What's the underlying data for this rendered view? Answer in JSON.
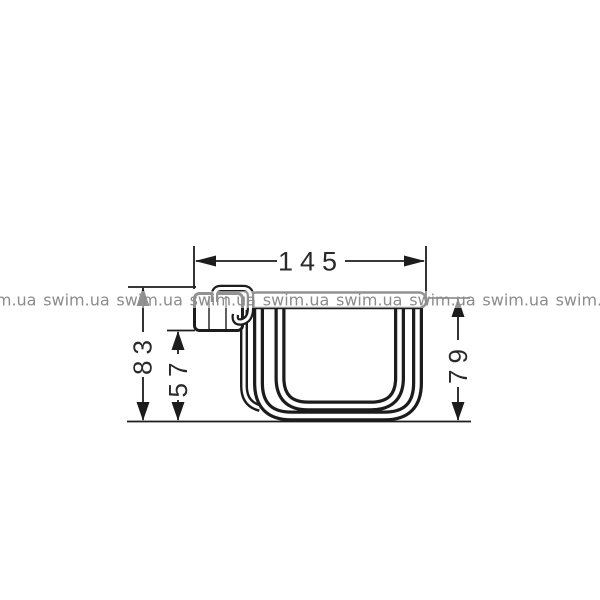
{
  "watermark": {
    "text": "swim.ua"
  },
  "dimensions": {
    "width": "145",
    "overall_height": "83",
    "basket_height": "57",
    "right_height": "79"
  },
  "colors": {
    "line": "#1c1c1c",
    "dimension_text": "#2a2a2a",
    "watermark": "#8c8c8c",
    "background": "#ffffff"
  }
}
